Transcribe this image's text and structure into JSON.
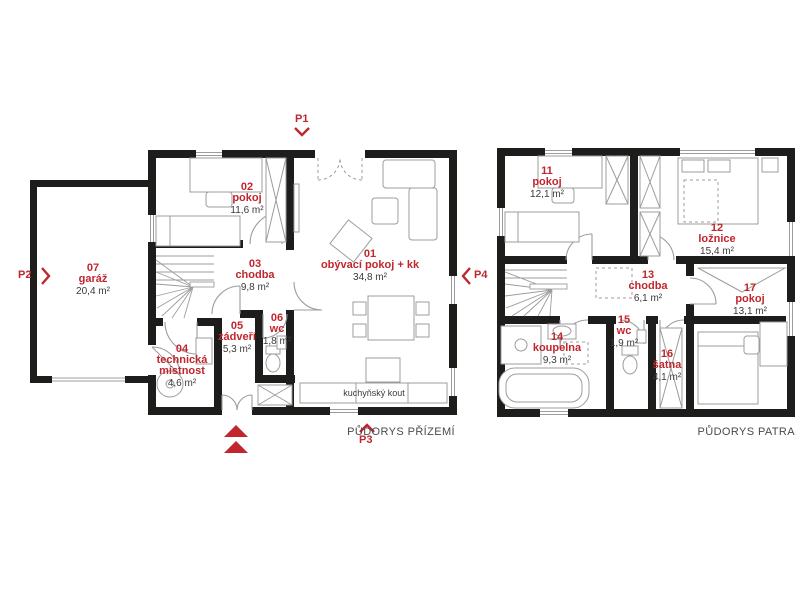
{
  "colors": {
    "wall": "#1d1d1b",
    "accent_red": "#c0262d",
    "furniture_gray": "#9c9c9c",
    "text_gray": "#3a3a39"
  },
  "markers": {
    "p1": "P1",
    "p2": "P2",
    "p3": "P3",
    "p4": "P4"
  },
  "ground_floor": {
    "caption": "PŮDORYS PŘÍZEMÍ",
    "kitchen_note": "kuchyňský kout",
    "rooms": [
      {
        "number": "01",
        "name": "obývací pokoj + kk",
        "area": "34,8 m²"
      },
      {
        "number": "02",
        "name": "pokoj",
        "area": "11,6 m²"
      },
      {
        "number": "03",
        "name": "chodba",
        "area": "9,8 m²"
      },
      {
        "number": "04",
        "name": "technická místnost",
        "area": "4,6 m²"
      },
      {
        "number": "05",
        "name": "zádveří",
        "area": "5,3 m²"
      },
      {
        "number": "06",
        "name": "wc",
        "area": "1,8 m²"
      },
      {
        "number": "07",
        "name": "garáž",
        "area": "20,4 m²"
      }
    ]
  },
  "upper_floor": {
    "caption": "PŮDORYS PATRA",
    "rooms": [
      {
        "number": "11",
        "name": "pokoj",
        "area": "12,1 m²"
      },
      {
        "number": "12",
        "name": "ložnice",
        "area": "15,4 m²"
      },
      {
        "number": "13",
        "name": "chodba",
        "area": "6,1 m²"
      },
      {
        "number": "14",
        "name": "koupelna",
        "area": "9,3 m²"
      },
      {
        "number": "15",
        "name": "wc",
        "area": "1,9 m²"
      },
      {
        "number": "16",
        "name": "šatna",
        "area": "4,1 m²"
      },
      {
        "number": "17",
        "name": "pokoj",
        "area": "13,1 m²"
      }
    ]
  }
}
